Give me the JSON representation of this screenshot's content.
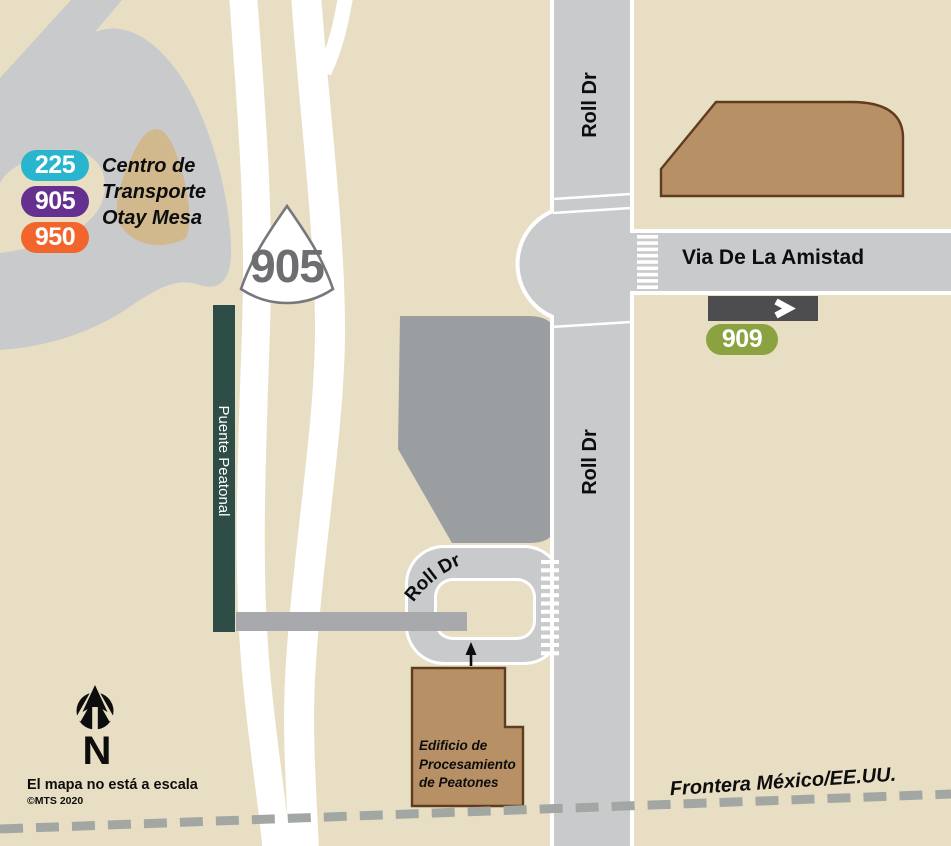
{
  "colors": {
    "background": "#e8dec4",
    "road_gray": "#c9cacc",
    "building_gray": "#9a9ea1",
    "walkway_gray": "#a7a9ac",
    "bridge_green": "#2d4d46",
    "building_brown": "#b89065",
    "building_brown_outline": "#5f3c1e",
    "route_225": "#29b5cd",
    "route_905": "#65308f",
    "route_950": "#f2662d",
    "route_909": "#8aa340",
    "direction_bar": "#4d4d4f",
    "border_dash": "#a3a7a3",
    "shield_gray": "#6d6e71",
    "shield_outline": "#77787b",
    "island_tan": "#d1b98d",
    "text_black": "#0d0d0d"
  },
  "legend": {
    "routes": [
      {
        "number": "225"
      },
      {
        "number": "905"
      },
      {
        "number": "950"
      }
    ],
    "title_lines": [
      "Centro de",
      "Transporte",
      "Otay Mesa"
    ]
  },
  "highway_shield": {
    "number": "905"
  },
  "streets": {
    "roll_dr_north": "Roll Dr",
    "roll_dr_south": "Roll Dr",
    "roll_dr_loop": "Roll Dr",
    "via_de_la_amistad": "Via De La Amistad"
  },
  "transit": {
    "route_909_badge": "909"
  },
  "features": {
    "pedestrian_bridge": "Puente Peatonal",
    "processing_building_lines": [
      "Edificio de",
      "Procesamiento",
      "de Peatones"
    ],
    "border_label": "Frontera México/EE.UU."
  },
  "compass": {
    "north_letter": "N"
  },
  "footnotes": {
    "scale_note": "El mapa no está a escala",
    "copyright": "©MTS 2020"
  }
}
